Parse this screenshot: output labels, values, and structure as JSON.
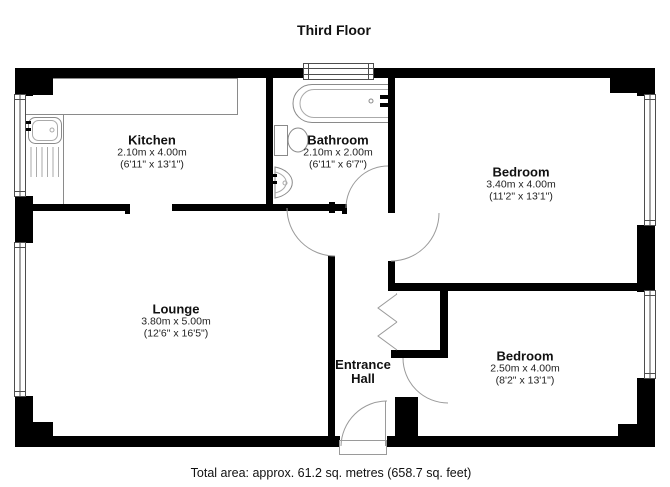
{
  "title": "Third Floor",
  "footer": "Total area: approx. 61.2 sq. metres (658.7 sq. feet)",
  "rooms": {
    "kitchen": {
      "name": "Kitchen",
      "metric": "2.10m x 4.00m",
      "imperial": "(6'11\" x 13'1\")"
    },
    "bathroom": {
      "name": "Bathroom",
      "metric": "2.10m x 2.00m",
      "imperial": "(6'11\" x 6'7\")"
    },
    "bedroom1": {
      "name": "Bedroom",
      "metric": "3.40m x 4.00m",
      "imperial": "(11'2\" x 13'1\")"
    },
    "lounge": {
      "name": "Lounge",
      "metric": "3.80m x 5.00m",
      "imperial": "(12'6\" x 16'5\")"
    },
    "entrance_hall": {
      "name_line1": "Entrance",
      "name_line2": "Hall"
    },
    "bedroom2": {
      "name": "Bedroom",
      "metric": "2.50m x 4.00m",
      "imperial": "(8'2\" x 13'1\")"
    }
  },
  "colors": {
    "wall": "#000000",
    "background": "#ffffff",
    "fixture_outline": "#8a8a8a",
    "window_outline": "#4d4d4d",
    "door_arc": "#9a9a9a",
    "text": "#111111"
  }
}
